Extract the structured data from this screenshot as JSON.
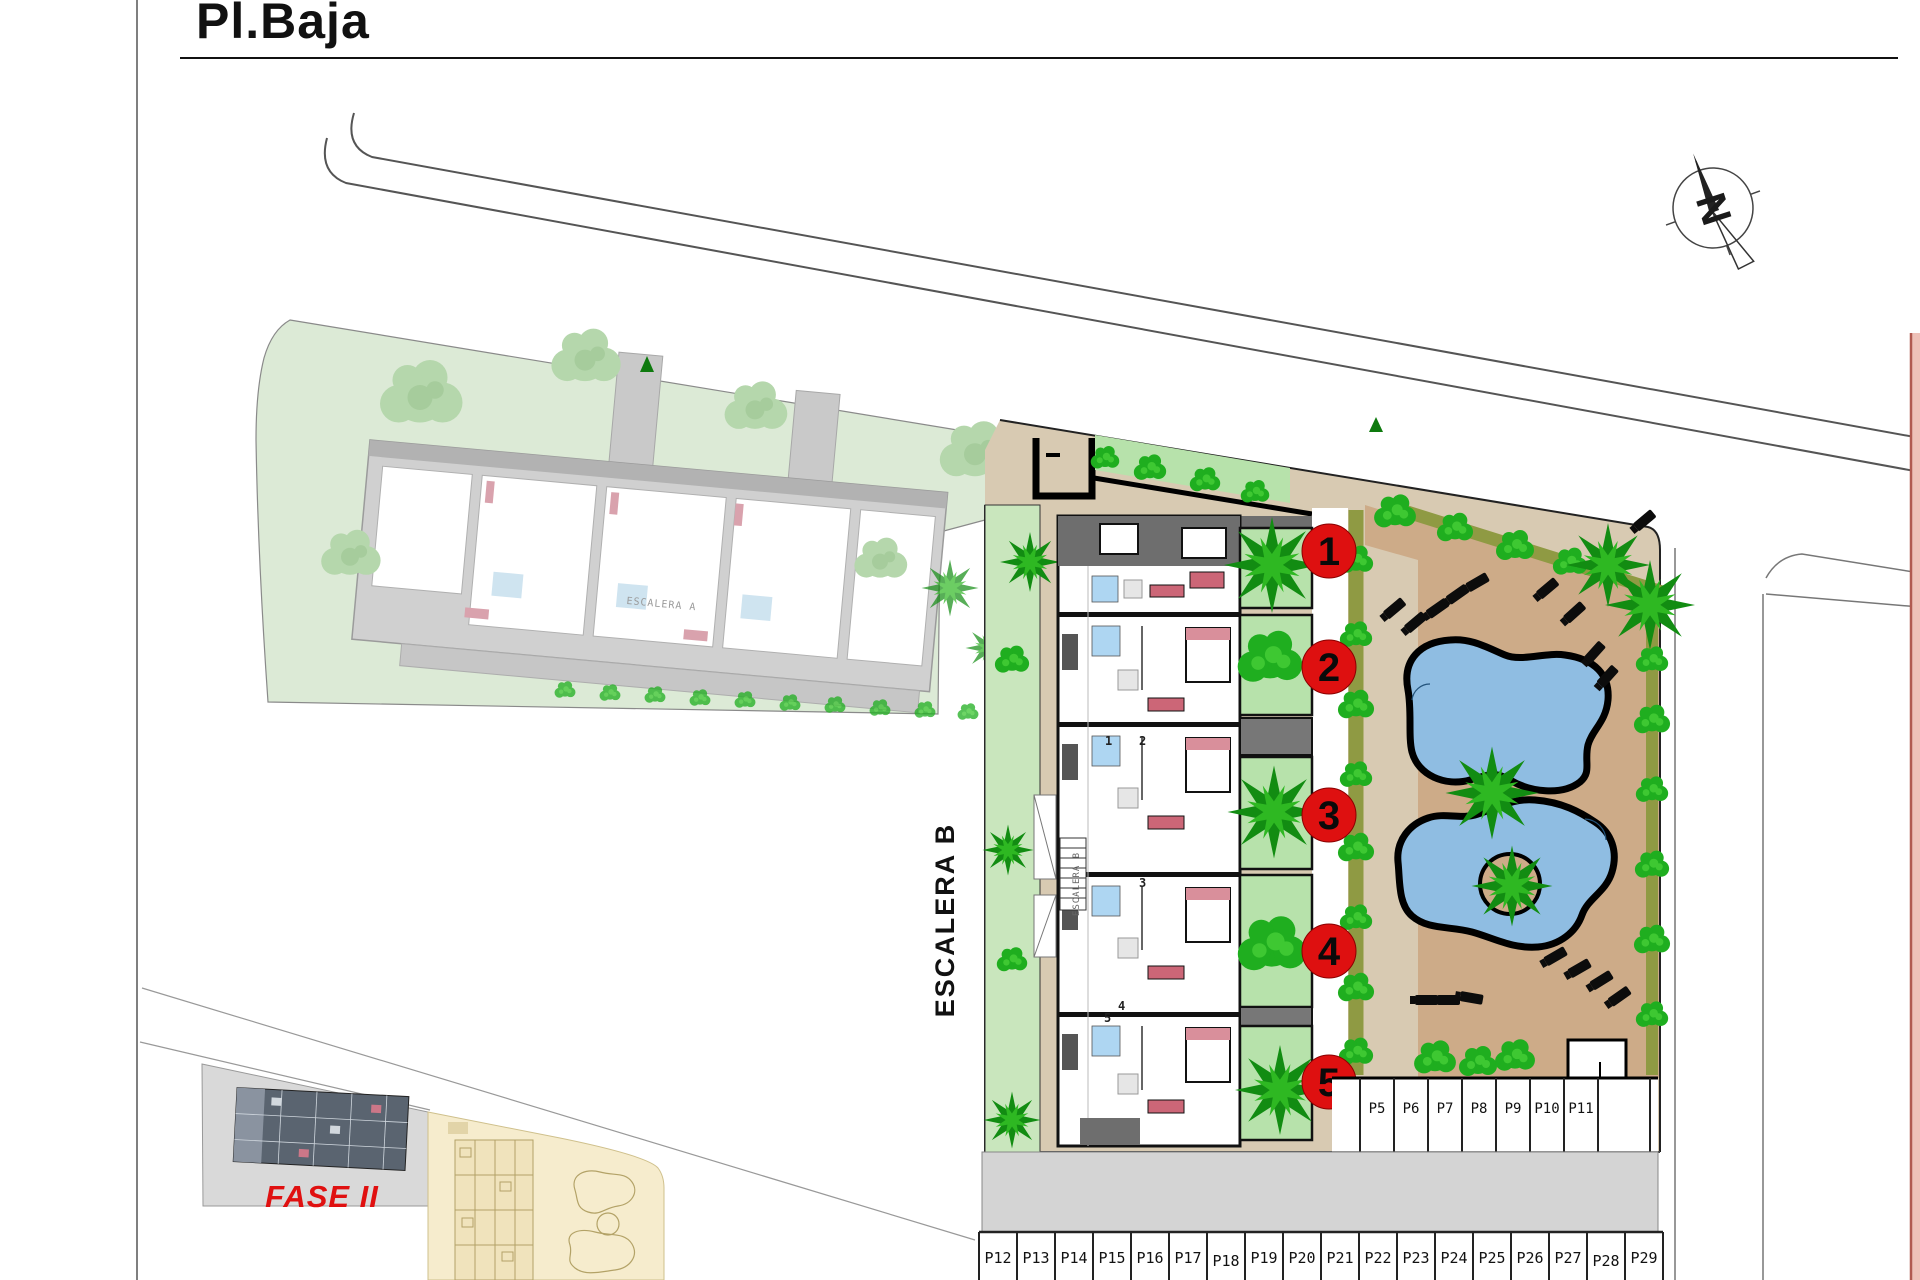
{
  "page": {
    "title": "Pl.Baja"
  },
  "compass": {
    "north_label": "N"
  },
  "labels": {
    "escalera_b": "ESCALERA B",
    "escalera_a": "ESCALERA A",
    "escalera_b_core": "ESCALERA B",
    "fase_2": "FASE II"
  },
  "unit_markers": [
    {
      "label": "1"
    },
    {
      "label": "2"
    },
    {
      "label": "3"
    },
    {
      "label": "4"
    },
    {
      "label": "5"
    }
  ],
  "unit_numbers": [
    "1",
    "2",
    "3",
    "4",
    "5"
  ],
  "parking": {
    "side_row": [
      "P5",
      "P6",
      "P7",
      "P8",
      "P9",
      "P10",
      "P11"
    ],
    "bottom_row": [
      "P12",
      "P13",
      "P14",
      "P15",
      "P16",
      "P17",
      "P18",
      "P19",
      "P20",
      "P21",
      "P22",
      "P23",
      "P24",
      "P25",
      "P26",
      "P27",
      "P28",
      "P29"
    ]
  },
  "colors": {
    "marker_red": "#de1010",
    "fase_red": "#e01010",
    "pool_water": "#8fbde2",
    "deck_tan": "#cdab88",
    "plaza_tan": "#d8cab2",
    "lawn_green": "#dcead6",
    "patio_green": "#b7e2ab",
    "strip_green": "#c9e6bd",
    "hedge_olive": "#8f9a43",
    "road_gray": "#d4d4d4",
    "inset_gray": "#d9d9d9",
    "inset_yellow": "#f6eccd",
    "strip_pink": "#eec1b8"
  }
}
